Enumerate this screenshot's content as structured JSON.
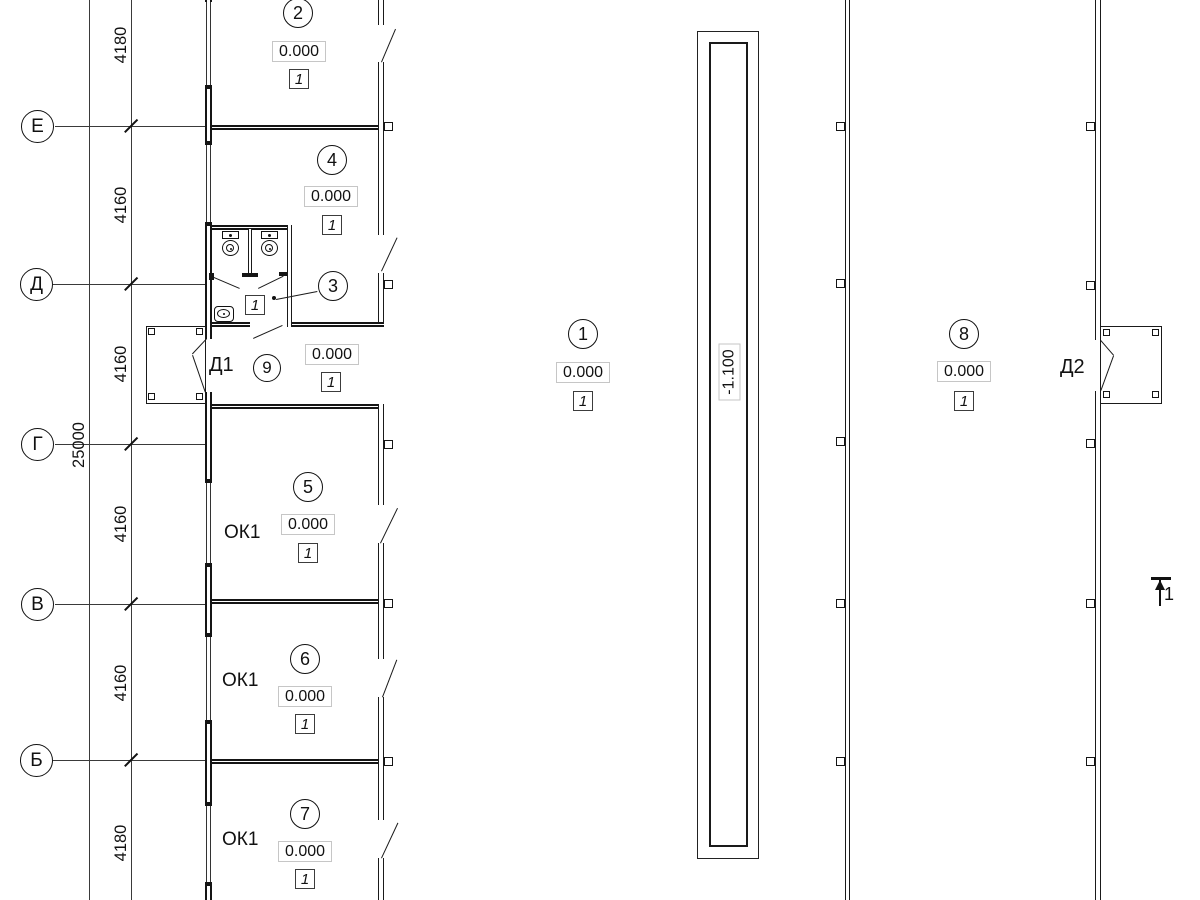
{
  "axes": {
    "labels": [
      "Е",
      "Д",
      "Г",
      "В",
      "Б"
    ]
  },
  "dimensions": {
    "segments": [
      "4180",
      "4160",
      "4160",
      "4160",
      "4160",
      "4180"
    ],
    "total": "25000"
  },
  "rooms": {
    "r2": {
      "number": "2",
      "elevation": "0.000",
      "finish": "1"
    },
    "r4": {
      "number": "4",
      "elevation": "0.000",
      "finish": "1"
    },
    "r3": {
      "number": "3",
      "elevation": "0.000",
      "finish": "1",
      "wc_finish": "1"
    },
    "r9": {
      "number": "9"
    },
    "r1": {
      "number": "1",
      "elevation": "0.000",
      "finish": "1"
    },
    "r5": {
      "number": "5",
      "elevation": "0.000",
      "finish": "1"
    },
    "r6": {
      "number": "6",
      "elevation": "0.000",
      "finish": "1"
    },
    "r7": {
      "number": "7",
      "elevation": "0.000",
      "finish": "1"
    },
    "r8": {
      "number": "8",
      "elevation": "0.000",
      "finish": "1"
    }
  },
  "doors": {
    "d1": "Д1",
    "d2": "Д2"
  },
  "labels": {
    "ok1": "ОК1"
  },
  "pit": {
    "elevation": "-1.100"
  },
  "section": {
    "label": "1"
  }
}
